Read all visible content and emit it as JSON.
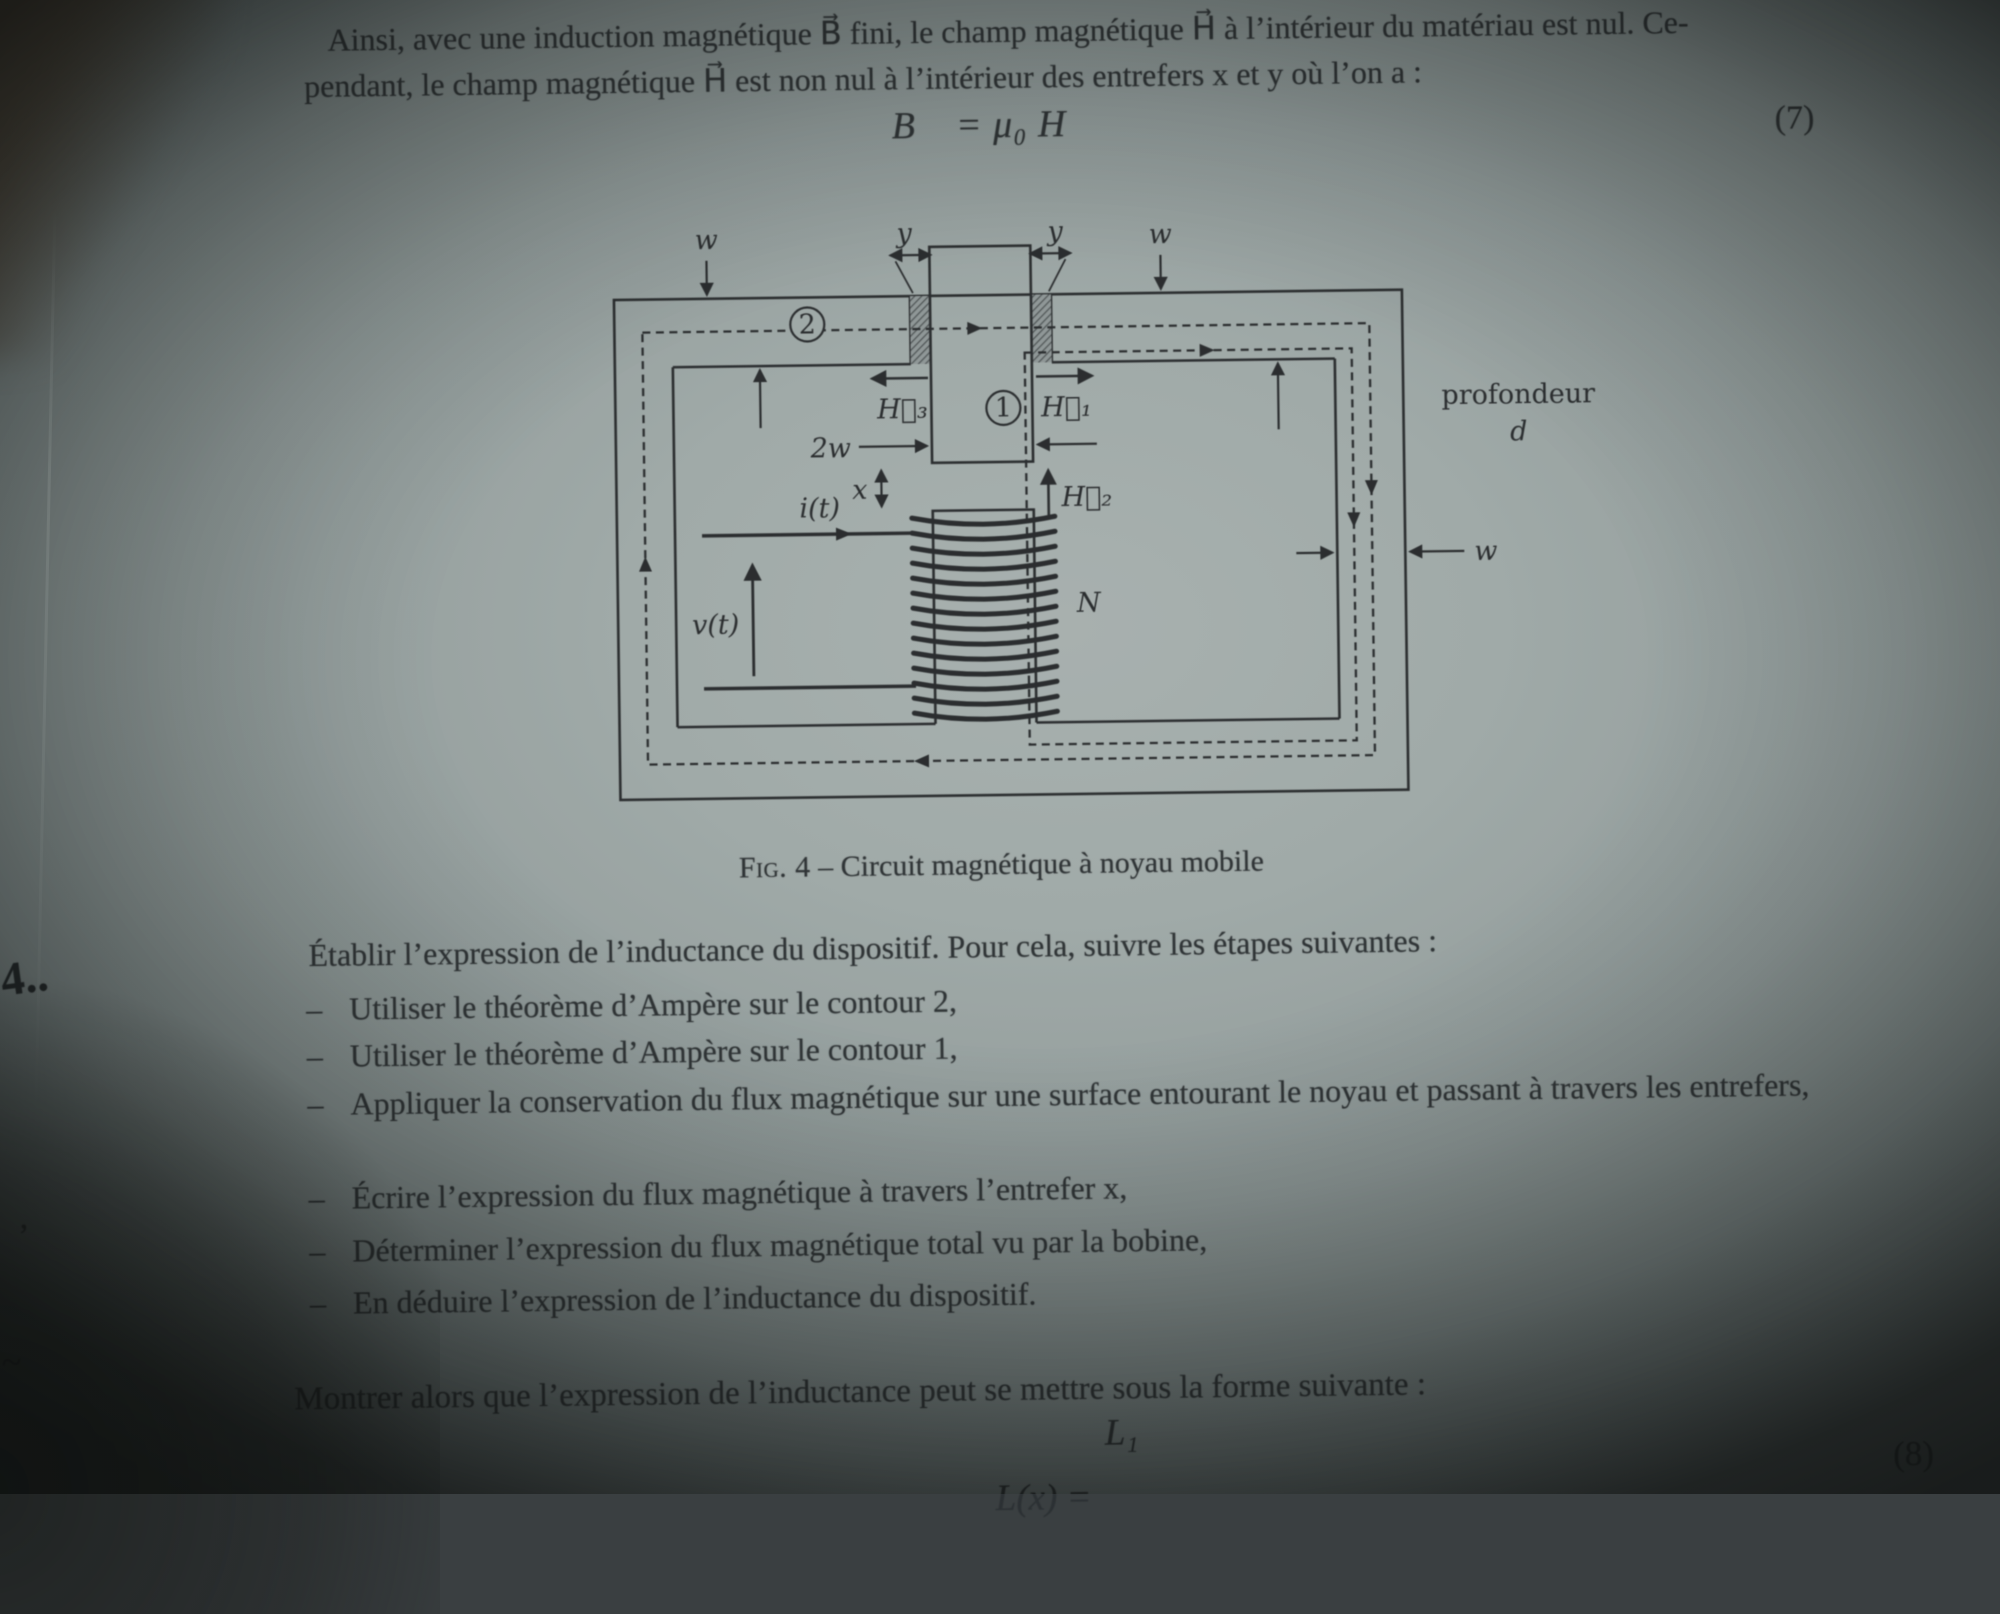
{
  "paragraph": {
    "line1": "Ainsi, avec une induction magnétique B⃗ fini, le champ magnétique H⃗ à l’intérieur du matériau est nul. Ce-",
    "line2": "pendant, le champ magnétique H⃗ est non nul à l’intérieur des entrefers x et y où l’on a :"
  },
  "equation7": {
    "body": "B⃗ = μ₀ H⃗",
    "number": "(7)"
  },
  "figure": {
    "caption_label": "Fig. 4",
    "caption_dash": "–",
    "caption_text": "Circuit magnétique à noyau mobile",
    "labels": {
      "w": "w",
      "y": "y",
      "two_w": "2w",
      "x": "x",
      "H1": "H⃗₁",
      "H2": "H⃗₂",
      "H3": "H⃗₃",
      "contour1": "1",
      "contour2": "2",
      "i": "i(t)",
      "v": "v(t)",
      "N": "N",
      "depth1": "profondeur",
      "depth2": "d"
    }
  },
  "margin": {
    "section": "4..",
    "mark1": "’",
    "mark2": "~"
  },
  "task": {
    "intro": "Établir l’expression de l’inductance du dispositif. Pour cela, suivre les étapes suivantes :",
    "dash": "–",
    "items": [
      "Utiliser le théorème d’Ampère sur le contour 2,",
      "Utiliser le théorème d’Ampère sur le contour 1,",
      "Appliquer la conservation du flux magnétique sur une surface entourant le noyau et passant à travers les entrefers,",
      "Écrire l’expression du flux magnétique à travers l’entrefer x,",
      "Déterminer l’expression du flux magnétique total vu par la bobine,",
      "En déduire l’expression de l’inductance du dispositif."
    ],
    "closing": "Montrer alors que l’expression de l’inductance peut se mettre sous la forme suivante :"
  },
  "equation8": {
    "lhs": "L(x) =",
    "numerator": "L₁",
    "number": "(8)"
  }
}
